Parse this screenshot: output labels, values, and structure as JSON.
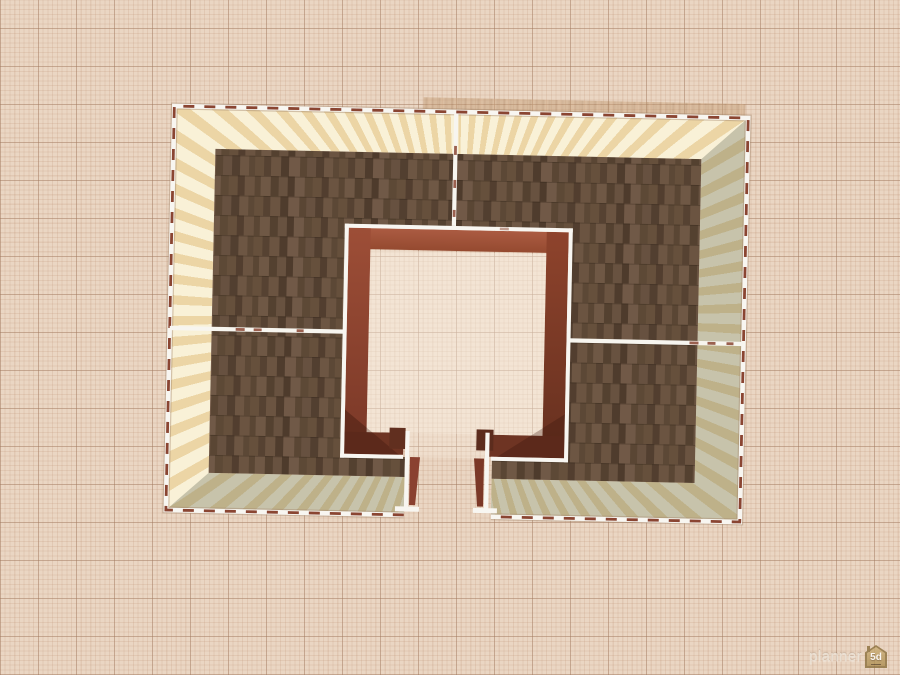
{
  "watermark": {
    "text": "planner",
    "badge": "5d"
  },
  "canvas": {
    "background_color": "#ead6c3",
    "grid_minor_color": "#d9bda8",
    "grid_major_color": "#c3a78f",
    "grid_minor_step_px": 4.75,
    "grid_major_step_px": 38
  },
  "selection": {
    "is_selected": true,
    "outline_style": "dashed",
    "outline_color": "#8a4532",
    "wall_outline_color": "#f8f6f1"
  },
  "building": {
    "view": "2d-top",
    "rotation_deg": 1.2,
    "rooms_count": 4,
    "outer_wall_texture": "striped-wallpaper",
    "outer_wall_stripe_light": "#f9f1d7",
    "outer_wall_stripe_dark": "#ecd5a5",
    "shaded_wall_stripe_light": "#cfc9ae",
    "shaded_wall_stripe_dark": "#b3ab8d",
    "floor_texture": "wood-shingle",
    "floor_base_color": "#5f4936",
    "inner_room_wall_color": "#a4553e",
    "inner_room_wall_shaded_color": "#6e3423",
    "has_inner_courtyard": true,
    "has_bottom_opening": true
  }
}
